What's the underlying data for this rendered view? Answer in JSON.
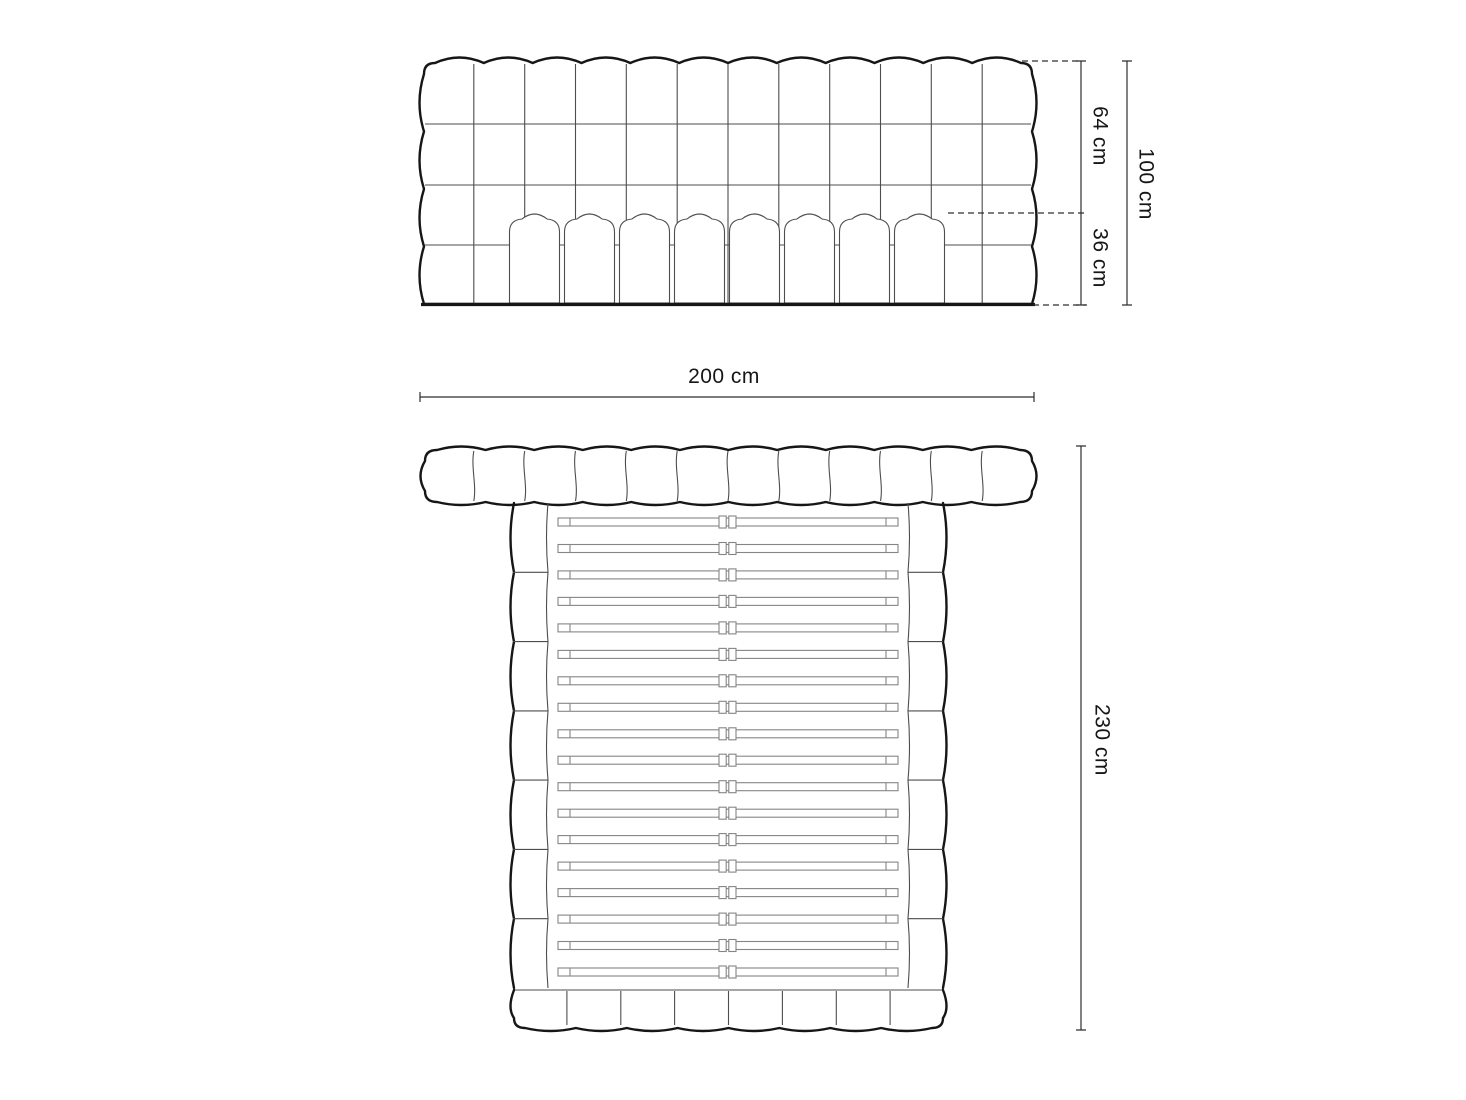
{
  "diagram": {
    "type": "furniture-dimension-drawing",
    "subject": "upholstered bed with tufted headboard",
    "views": {
      "front": {
        "name": "headboard-front-view",
        "headboard_tuft_columns": 12,
        "headboard_tuft_rows": 4,
        "mattress_segments": 8
      },
      "top": {
        "name": "bed-top-view",
        "headboard_segments": 12,
        "side_cushions_per_rail": 7,
        "slats": 18,
        "footboard_segments": 8
      }
    }
  },
  "dimensions": {
    "headboard_upper_height": "64 cm",
    "headboard_lower_height": "36 cm",
    "headboard_total_height": "100 cm",
    "bed_width": "200 cm",
    "bed_length": "230 cm"
  },
  "colors": {
    "background": "#ffffff",
    "outline": "#161616",
    "tuft_line": "#4d4d4d",
    "slat_line": "#858585",
    "dimension_line": "#2e2e2e",
    "label_text": "#161616"
  }
}
